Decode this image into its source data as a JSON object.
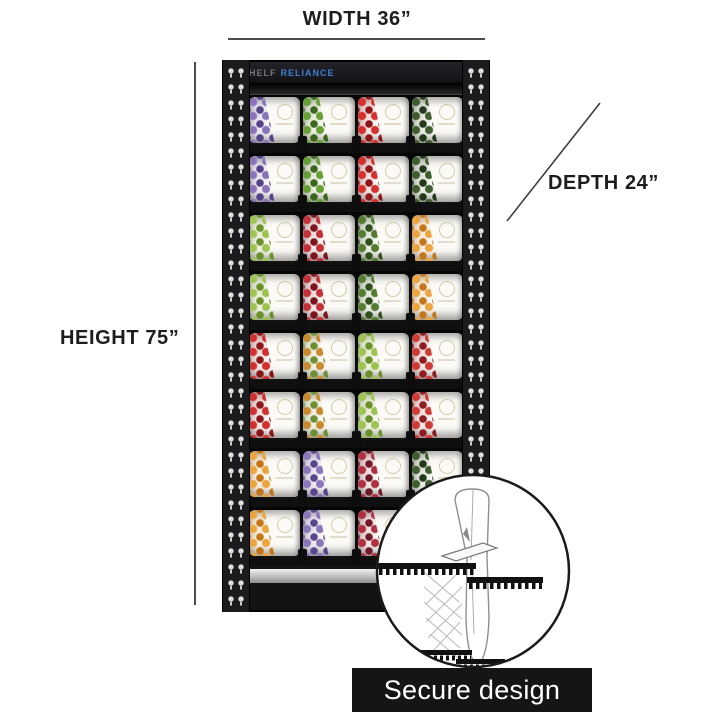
{
  "dimensions": {
    "width_label": "WIDTH 36”",
    "height_label": "HEIGHT 75”",
    "depth_label": "DEPTH 24”"
  },
  "brand": {
    "part1": "SHELF",
    "part2": "RELIANCE"
  },
  "inset": {
    "caption": "Secure design"
  },
  "colors": {
    "frame": "#17171a",
    "brand_blue": "#3e7fd0",
    "brand_gray": "#70757b",
    "dimension_text": "#1d1d1d",
    "caption_bg": "#151515",
    "caption_text": "#ffffff",
    "silver_trim": "#bcbcbc"
  },
  "shelf": {
    "rows": [
      {
        "cans": [
          {
            "name": "blueberries",
            "c1": "#8a74b8",
            "c2": "#55418a"
          },
          {
            "name": "chives",
            "c1": "#66a035",
            "c2": "#3c661c"
          },
          {
            "name": "red-peppers",
            "c1": "#d62f2e",
            "c2": "#8f1518"
          },
          {
            "name": "spinach",
            "c1": "#3f5d2e",
            "c2": "#22381a"
          }
        ]
      },
      {
        "cans": [
          {
            "name": "blueberries",
            "c1": "#8a74b8",
            "c2": "#55418a"
          },
          {
            "name": "chives",
            "c1": "#66a035",
            "c2": "#3c661c"
          },
          {
            "name": "red-peppers",
            "c1": "#d62f2e",
            "c2": "#8f1518"
          },
          {
            "name": "spinach",
            "c1": "#3f5d2e",
            "c2": "#22381a"
          }
        ]
      },
      {
        "cans": [
          {
            "name": "green-apples",
            "c1": "#9dc351",
            "c2": "#6a9028"
          },
          {
            "name": "strawberries",
            "c1": "#c53038",
            "c2": "#7c141e"
          },
          {
            "name": "cucumbers",
            "c1": "#537c31",
            "c2": "#2f4f1a"
          },
          {
            "name": "peaches",
            "c1": "#eca43e",
            "c2": "#c4761a"
          }
        ]
      },
      {
        "cans": [
          {
            "name": "green-apples",
            "c1": "#9dc351",
            "c2": "#6a9028"
          },
          {
            "name": "strawberries",
            "c1": "#c53038",
            "c2": "#7c141e"
          },
          {
            "name": "cucumbers",
            "c1": "#537c31",
            "c2": "#2f4f1a"
          },
          {
            "name": "peaches",
            "c1": "#eca43e",
            "c2": "#c4761a"
          }
        ]
      },
      {
        "cans": [
          {
            "name": "red-bell-peppers",
            "c1": "#d03030",
            "c2": "#8a1418"
          },
          {
            "name": "veggie-blend",
            "c1": "#c98a2e",
            "c2": "#6f8f35"
          },
          {
            "name": "green-apples",
            "c1": "#9dc351",
            "c2": "#6a9028"
          },
          {
            "name": "strawberries",
            "c1": "#ce3a36",
            "c2": "#8e1c22"
          }
        ]
      },
      {
        "cans": [
          {
            "name": "red-bell-peppers",
            "c1": "#d03030",
            "c2": "#8a1418"
          },
          {
            "name": "veggie-blend",
            "c1": "#c98a2e",
            "c2": "#6f8f35"
          },
          {
            "name": "green-apples",
            "c1": "#9dc351",
            "c2": "#6a9028"
          },
          {
            "name": "strawberries",
            "c1": "#ce3a36",
            "c2": "#8e1c22"
          }
        ]
      },
      {
        "cans": [
          {
            "name": "apricots",
            "c1": "#eaa53f",
            "c2": "#c37416"
          },
          {
            "name": "blueberries",
            "c1": "#8b76bb",
            "c2": "#5a4590"
          },
          {
            "name": "pomegranates",
            "c1": "#b03040",
            "c2": "#701828"
          },
          {
            "name": "spinach",
            "c1": "#3f5d2e",
            "c2": "#22381a"
          }
        ]
      },
      {
        "cans": [
          {
            "name": "apricots",
            "c1": "#eaa53f",
            "c2": "#c37416"
          },
          {
            "name": "blueberries",
            "c1": "#8b76bb",
            "c2": "#5a4590"
          },
          {
            "name": "pomegranates",
            "c1": "#b03040",
            "c2": "#701828"
          },
          {
            "name": "spinach",
            "c1": "#3f5d2e",
            "c2": "#22381a"
          }
        ]
      }
    ]
  }
}
